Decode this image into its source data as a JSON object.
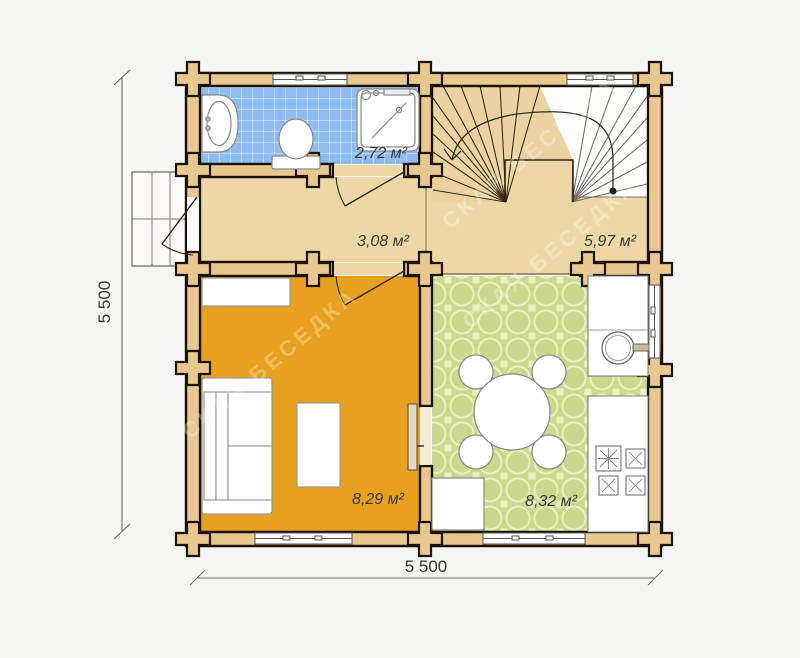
{
  "plan": {
    "title": "log-cabin-ground-floor-plan",
    "rooms": [
      {
        "id": "bathroom",
        "area_label": "2,72 м²"
      },
      {
        "id": "hallway",
        "area_label": "3,08 м²"
      },
      {
        "id": "stair-hall",
        "area_label": "5,97 м²"
      },
      {
        "id": "living-room",
        "area_label": "8,29 м²"
      },
      {
        "id": "kitchen",
        "area_label": "8,32 м²"
      }
    ],
    "dimensions": {
      "bottom_width_label": "5 500",
      "left_height_label": "5 500"
    },
    "watermark": "СКАЯ БЕСЕДКА",
    "colors": {
      "background": "#f5f5f3",
      "wall_fill": "#e9c88f",
      "wall_outline": "#1b130a",
      "hall_floor": "#eed7a4",
      "bathroom_tile": "#8fbcf0",
      "living_floor": "#e7a11f",
      "kitchen_floor": "#ccd88e",
      "fixture_fill": "#ffffff"
    }
  }
}
